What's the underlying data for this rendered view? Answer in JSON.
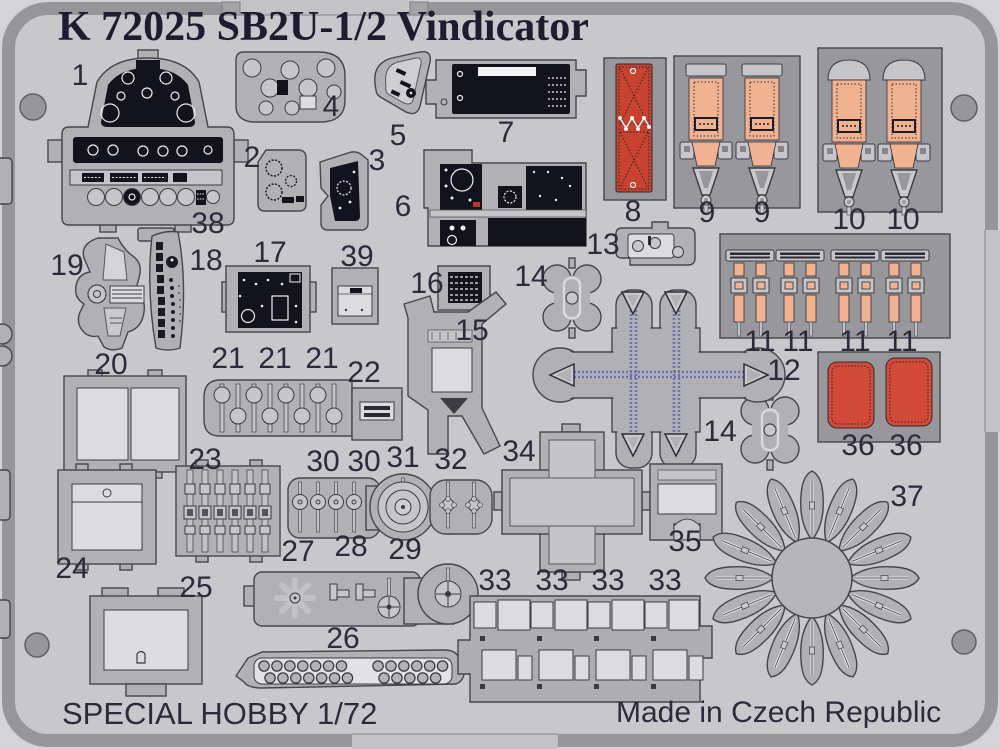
{
  "title": "K 72025 SB2U-1/2 Vindicator",
  "footer": {
    "left": "SPECIAL HOBBY 1/72",
    "right": "Made in Czech Republic"
  },
  "colors": {
    "outer": "#d4d4d6",
    "sheet": "#c8c8cc",
    "border_band": "#95959a",
    "part_gray": "#b1b1b5",
    "panel_gray": "#98989c",
    "instrument_black": "#13131d",
    "belt_salmon": "#f1b292",
    "pad_red": "#c8432f",
    "cushion_red": "#d44a38",
    "strap_purple": "#6f6fb4",
    "label_color": "#2b2b3b"
  },
  "part_labels": [
    {
      "text": "1",
      "x": 80,
      "y": 76
    },
    {
      "text": "4",
      "x": 331,
      "y": 107
    },
    {
      "text": "5",
      "x": 398,
      "y": 136
    },
    {
      "text": "7",
      "x": 506,
      "y": 133
    },
    {
      "text": "2",
      "x": 252,
      "y": 158
    },
    {
      "text": "3",
      "x": 377,
      "y": 161
    },
    {
      "text": "6",
      "x": 403,
      "y": 207
    },
    {
      "text": "38",
      "x": 208,
      "y": 224
    },
    {
      "text": "8",
      "x": 633,
      "y": 212
    },
    {
      "text": "9",
      "x": 707,
      "y": 213
    },
    {
      "text": "9",
      "x": 762,
      "y": 213
    },
    {
      "text": "10",
      "x": 849,
      "y": 220
    },
    {
      "text": "10",
      "x": 903,
      "y": 220
    },
    {
      "text": "13",
      "x": 603,
      "y": 245
    },
    {
      "text": "19",
      "x": 67,
      "y": 266
    },
    {
      "text": "18",
      "x": 206,
      "y": 261
    },
    {
      "text": "17",
      "x": 270,
      "y": 253
    },
    {
      "text": "39",
      "x": 357,
      "y": 257
    },
    {
      "text": "16",
      "x": 427,
      "y": 284
    },
    {
      "text": "14",
      "x": 531,
      "y": 277
    },
    {
      "text": "15",
      "x": 472,
      "y": 331
    },
    {
      "text": "12",
      "x": 784,
      "y": 371
    },
    {
      "text": "11",
      "x": 760,
      "y": 342
    },
    {
      "text": "11",
      "x": 798,
      "y": 342
    },
    {
      "text": "11",
      "x": 855,
      "y": 342
    },
    {
      "text": "11",
      "x": 902,
      "y": 342
    },
    {
      "text": "20",
      "x": 111,
      "y": 365
    },
    {
      "text": "21",
      "x": 228,
      "y": 359
    },
    {
      "text": "21",
      "x": 275,
      "y": 359
    },
    {
      "text": "21",
      "x": 322,
      "y": 359
    },
    {
      "text": "22",
      "x": 364,
      "y": 373
    },
    {
      "text": "36",
      "x": 858,
      "y": 446
    },
    {
      "text": "36",
      "x": 906,
      "y": 446
    },
    {
      "text": "14",
      "x": 720,
      "y": 432
    },
    {
      "text": "23",
      "x": 205,
      "y": 460
    },
    {
      "text": "30",
      "x": 323,
      "y": 462
    },
    {
      "text": "30",
      "x": 364,
      "y": 462
    },
    {
      "text": "31",
      "x": 403,
      "y": 458
    },
    {
      "text": "32",
      "x": 451,
      "y": 460
    },
    {
      "text": "34",
      "x": 519,
      "y": 452
    },
    {
      "text": "35",
      "x": 685,
      "y": 542
    },
    {
      "text": "37",
      "x": 907,
      "y": 497
    },
    {
      "text": "24",
      "x": 72,
      "y": 569
    },
    {
      "text": "25",
      "x": 196,
      "y": 588
    },
    {
      "text": "27",
      "x": 298,
      "y": 552
    },
    {
      "text": "28",
      "x": 351,
      "y": 547
    },
    {
      "text": "29",
      "x": 405,
      "y": 550
    },
    {
      "text": "33",
      "x": 495,
      "y": 581
    },
    {
      "text": "33",
      "x": 552,
      "y": 581
    },
    {
      "text": "33",
      "x": 608,
      "y": 581
    },
    {
      "text": "33",
      "x": 665,
      "y": 581
    },
    {
      "text": "26",
      "x": 343,
      "y": 639
    }
  ]
}
